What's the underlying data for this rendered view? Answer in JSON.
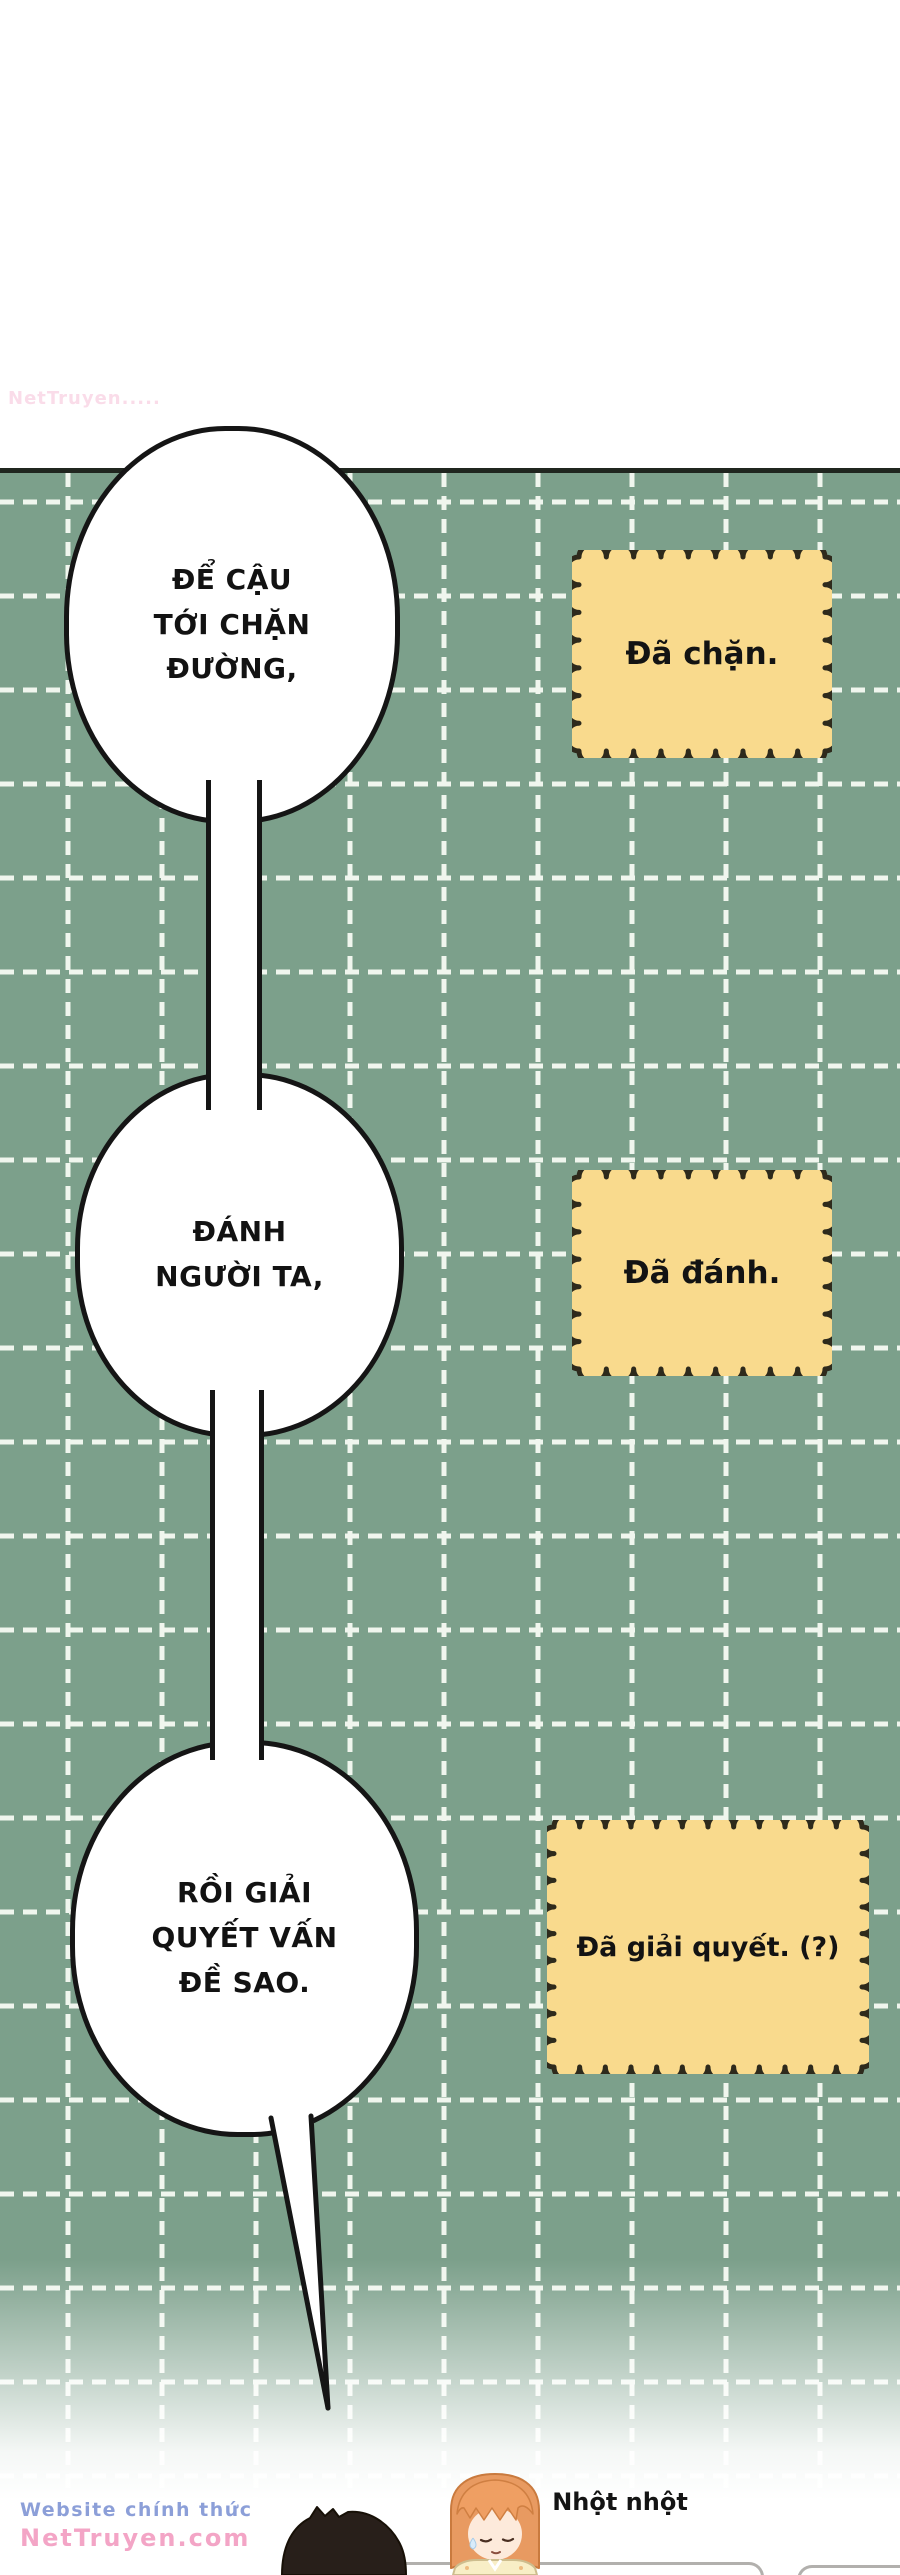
{
  "colors": {
    "panel-green": "#7ca08b",
    "grid-line": "#f0f6ee",
    "panel-top-border": "#20261f",
    "bubble-border": "#151515",
    "sticker-fill": "#f9da8d",
    "sticker-border": "#2e2a1c",
    "wm-blue": "#8c9fd8",
    "wm-pink": "#f3a5c6",
    "boy-hair": "#281f1a",
    "girl-hair": "#e89a61",
    "girl-shirt": "#f8eec6"
  },
  "bubbles": [
    {
      "text": "ĐỂ CẬU\nTỚI CHẶN\nĐƯỜNG,"
    },
    {
      "text": "ĐÁNH\nNGƯỜI TA,"
    },
    {
      "text": "RỒI GIẢI\nQUYẾT VẤN\nĐỀ SAO."
    }
  ],
  "stickers": [
    {
      "text": "Đã chặn."
    },
    {
      "text": "Đã đánh."
    },
    {
      "text": "Đã giải quyết. (?)"
    }
  ],
  "sfx": {
    "text": "Nhột nhột"
  },
  "watermark": {
    "line1": "Website chính thức",
    "line2": "NetTruyen.com",
    "faint": "NetTruyen....."
  }
}
